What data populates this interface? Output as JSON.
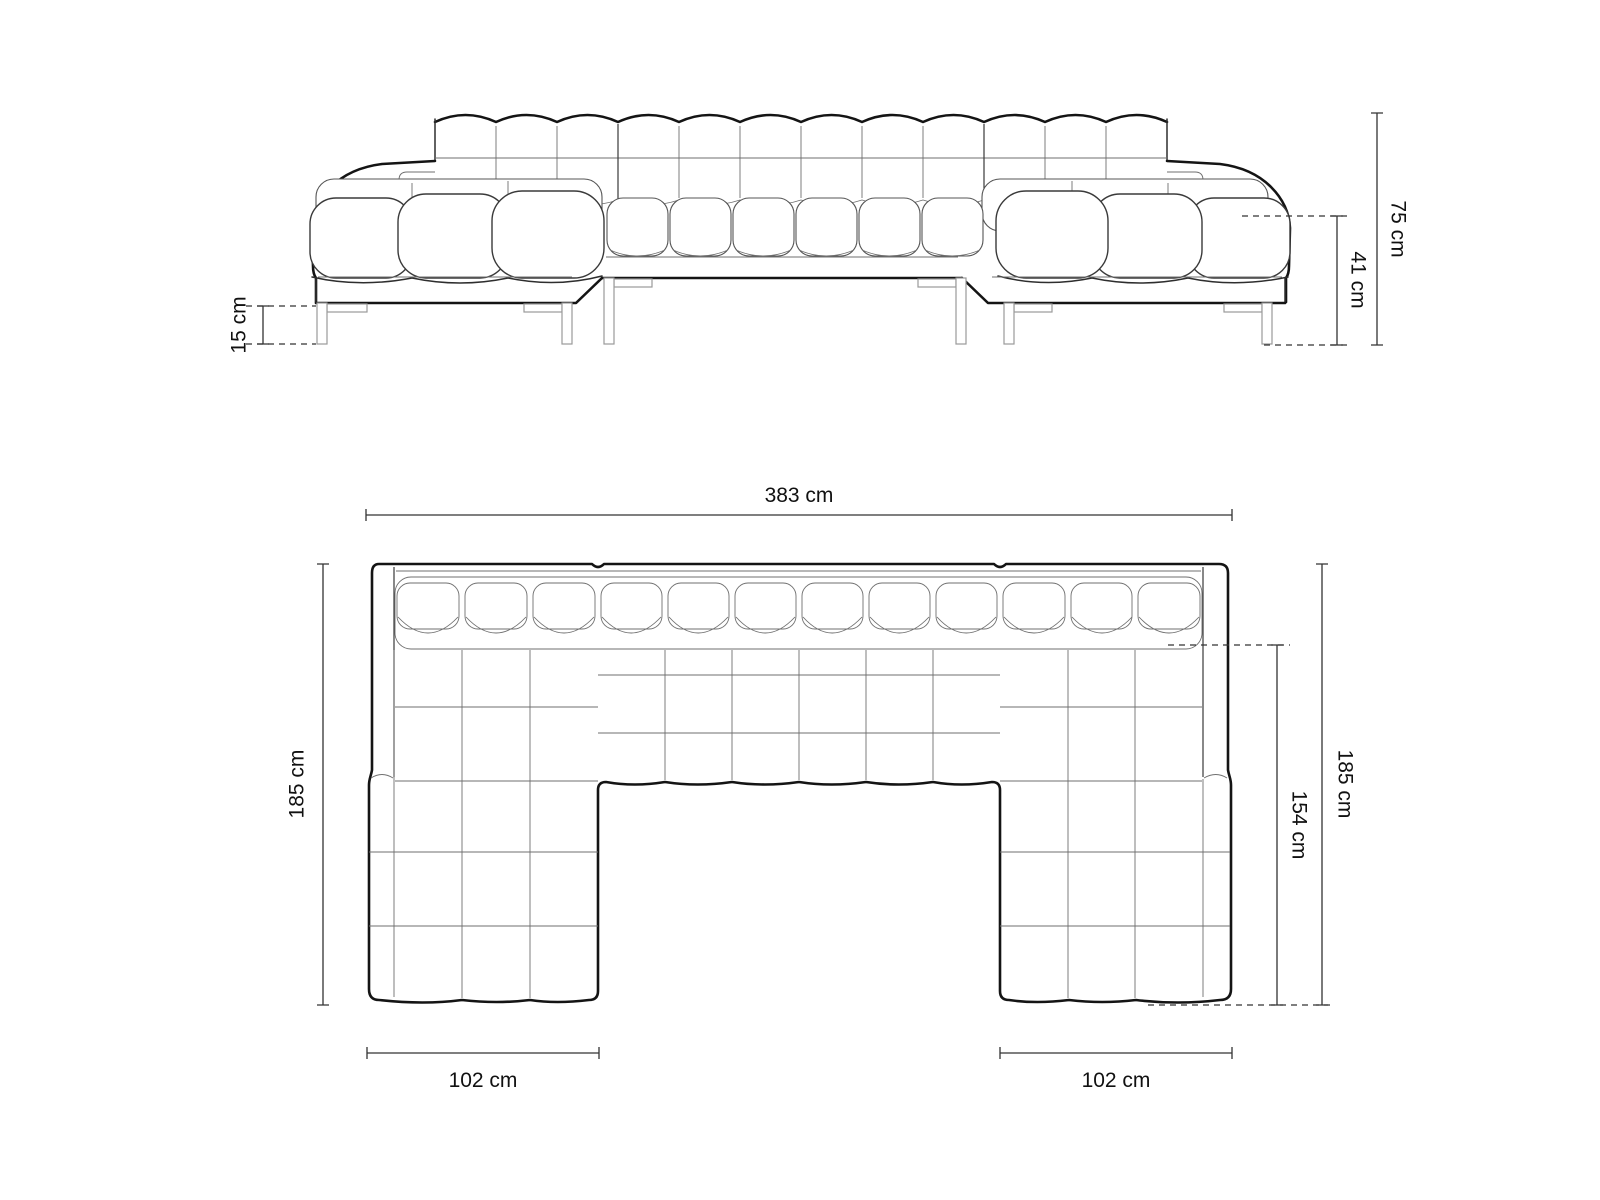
{
  "front_view": {
    "dimensions": {
      "total_height": "75 cm",
      "seat_height": "41 cm",
      "leg_height": "15 cm"
    }
  },
  "plan_view": {
    "dimensions": {
      "total_width": "383 cm",
      "depth_left": "185 cm",
      "depth_right": "185 cm",
      "chaise_depth_inner": "154 cm",
      "chaise_width_left": "102 cm",
      "chaise_width_right": "102 cm"
    }
  },
  "colors": {
    "outline": "#141414",
    "grid": "#6f6f6f",
    "legs": "#9a9a9a",
    "dimension_line": "#333333",
    "label_text": "#111111",
    "background": "#ffffff"
  }
}
